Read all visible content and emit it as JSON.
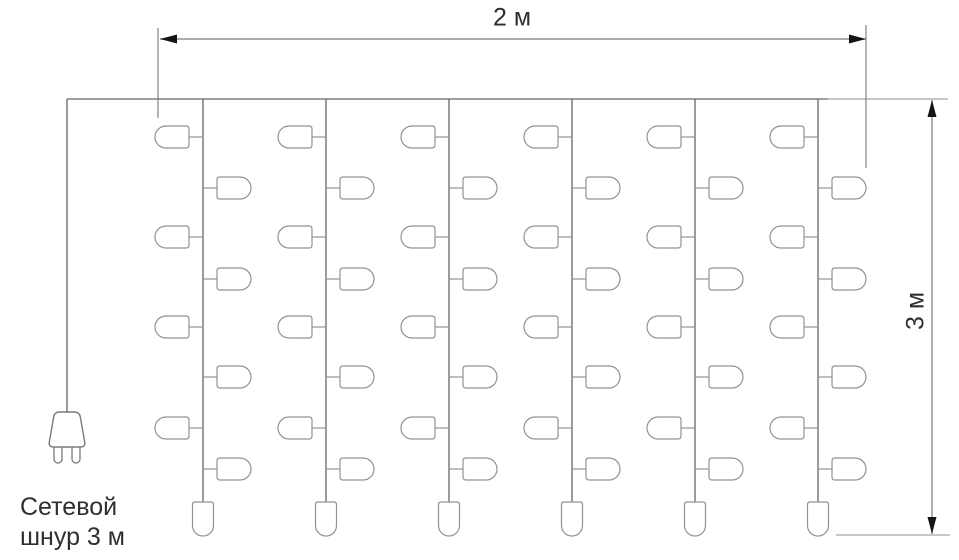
{
  "diagram": {
    "labels": {
      "width_dimension": "2 м",
      "height_dimension": "3 м",
      "power_cord_line1": "Сетевой",
      "power_cord_line2": "шнур 3 м"
    },
    "colors": {
      "background": "#ffffff",
      "wire": "#666666",
      "bulb_stroke": "#929292",
      "bulb_fill": "#ffffff",
      "plug_stroke": "#7a7a7a",
      "dimension_line": "#8f8f8f",
      "extension_line": "#6a6a6a",
      "arrowhead": "#141414",
      "text": "#2f2f2f"
    },
    "structure": {
      "string_count": 6,
      "side_bulbs_per_string": 8,
      "bottom_bulbs_per_string": 1
    },
    "geometry": {
      "canvas_w": 959,
      "canvas_h": 560,
      "wire": {
        "y": 99,
        "x1": 67,
        "x2": 828
      },
      "cord": {
        "x": 67,
        "y1": 99,
        "y2": 413
      },
      "plug": {
        "cx": 67,
        "body_top": 412,
        "body_bottom": 447,
        "top_width": 25,
        "bottom_width": 37,
        "corner_radius": 5,
        "prong_width": 8,
        "prong_height": 17,
        "prong_offset": 9
      },
      "strings_x": [
        203,
        326,
        449,
        572,
        695,
        818
      ],
      "string_bottom_y": 502,
      "side_bulb_rows": [
        {
          "side": "left",
          "y": 137
        },
        {
          "side": "right",
          "y": 188
        },
        {
          "side": "left",
          "y": 237
        },
        {
          "side": "right",
          "y": 279
        },
        {
          "side": "left",
          "y": 327
        },
        {
          "side": "right",
          "y": 377
        },
        {
          "side": "left",
          "y": 428
        },
        {
          "side": "right",
          "y": 469
        }
      ],
      "side_bulb": {
        "length": 34,
        "height": 22,
        "lead": 14
      },
      "bottom_bulb": {
        "width": 21,
        "height": 34
      },
      "dim_width": {
        "arrow_y": 39,
        "x1": 160,
        "x2": 866,
        "ext_left": {
          "x": 158,
          "y1": 28,
          "y2": 118
        },
        "ext_right": {
          "x": 866,
          "y1": 25,
          "y2": 168
        }
      },
      "dim_height": {
        "arrow_x": 932,
        "y1": 100,
        "y2": 534,
        "ext_top": {
          "y": 99,
          "x1": 828,
          "x2": 948
        },
        "ext_bottom": {
          "y": 535,
          "x1": 836,
          "x2": 950
        }
      }
    }
  }
}
